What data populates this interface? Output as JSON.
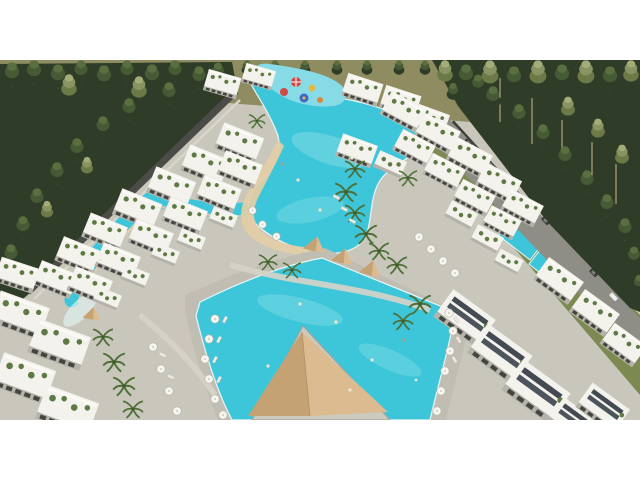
{
  "image": {
    "kind": "aerial-architectural-rendering",
    "subject": "resort complex with lagoon pools, white terraced apartment buildings, palm trees, pine forest, perimeter wall and road",
    "letterbox": {
      "top_px": 60,
      "bottom_px": 60,
      "content_width": 640,
      "content_height": 360
    }
  },
  "colors": {
    "letterbox": "#ffffff",
    "ground_deck": "#c9c6bb",
    "walk_path": "#d6d3c8",
    "olive_field": "#8f8c62",
    "grass": "#7c8a52",
    "forest_dark": "#2e3c28",
    "forest_mid": "#475a36",
    "pool_water": "#3dc6d9",
    "pool_water_light": "#86dbe6",
    "beach_sand": "#e3cda5",
    "road": "#8e8d86",
    "perimeter_wall": "#4b4b47",
    "building_white": "#f3f2ec",
    "building_shadow": "#b4b2aa",
    "windows": "#45453f",
    "roof_garden_green": "#5d7a44",
    "cabana_tan": "#dcbb90",
    "cabana_tan_dark": "#c5a273",
    "umbrella_white": "#f6f5f0",
    "aquapark_red": "#cf4a44",
    "aquapark_yellow": "#e2bc4a",
    "aquapark_blue": "#3e68c4",
    "aquapark_orange": "#d8883c",
    "car_dark": "#3a3a38",
    "car_white": "#e9e9e6",
    "swimmer": "#f2e6cf"
  }
}
